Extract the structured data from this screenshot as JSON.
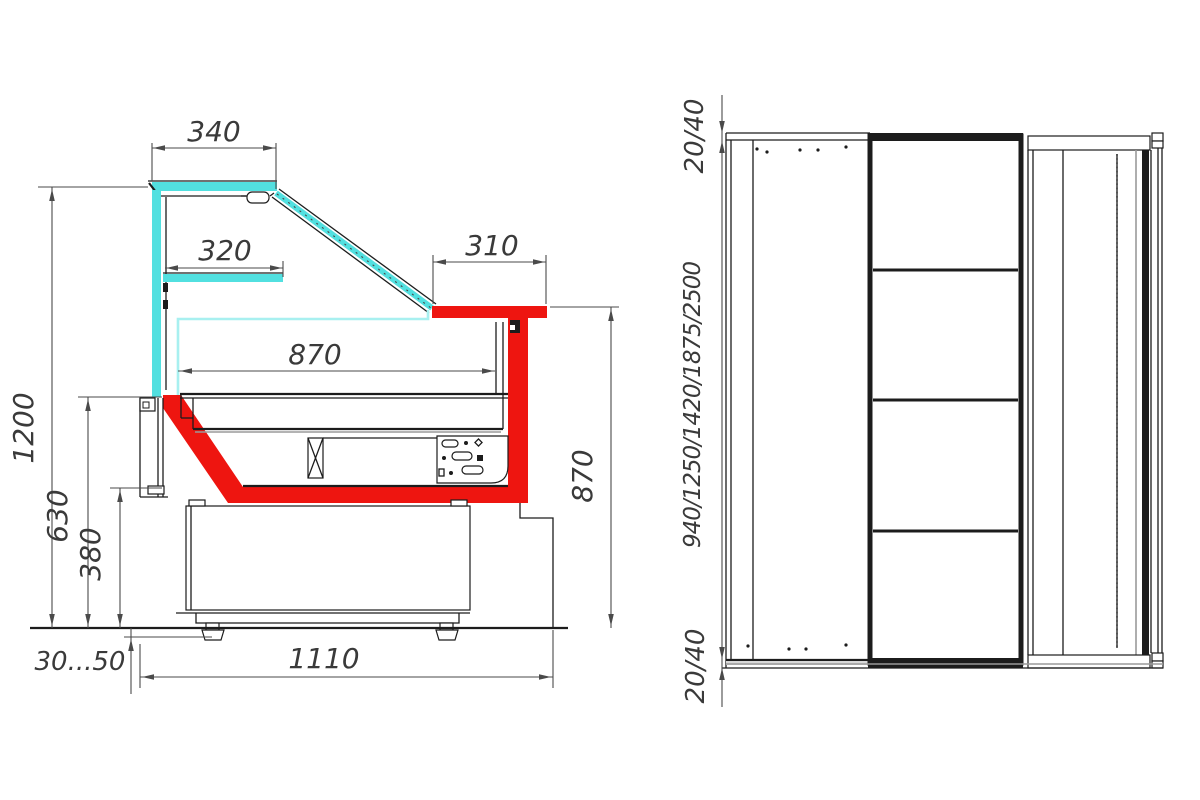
{
  "side_view": {
    "label": "side-cross-section",
    "dims": {
      "canopy_width": "340",
      "shelf_width": "320",
      "worktop_width": "310",
      "display_depth": "870",
      "overall_height": "1200",
      "counter_height": "630",
      "base_height": "380",
      "foot_adjust": "30...50",
      "base_length": "1110",
      "body_height": "870"
    }
  },
  "front_view": {
    "label": "front-elevation",
    "dims": {
      "top_panel": "20/40",
      "case_lengths": "940/1250/1420/1875/2500",
      "bottom_panel": "20/40"
    }
  },
  "colors": {
    "glass": "#52e0e0",
    "glass_light": "#a8f0f0",
    "accent_red": "#ee1510",
    "line": "#1c1c1c",
    "dim_line": "#4a4a4a",
    "dim_text": "#3a3a3a"
  }
}
